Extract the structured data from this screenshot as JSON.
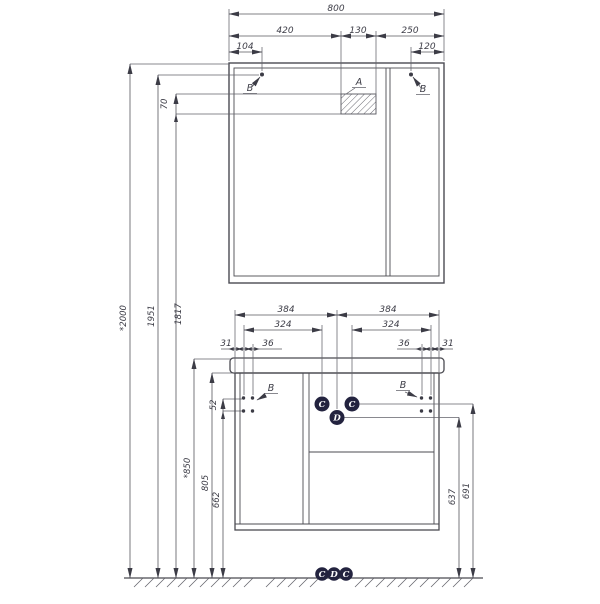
{
  "drawing": {
    "type": "technical-drawing",
    "subject": "Bathroom mirror cabinet and vanity unit, front elevation with installation dimensions",
    "units": "mm",
    "colors": {
      "line": "#4b4b52",
      "dim_line": "#56565e",
      "text": "#3c3c46",
      "badge_fill": "#23233f",
      "badge_text": "#ffffff",
      "background": "#ffffff"
    },
    "mirror_cabinet": {
      "width_total": "800",
      "width_left": "420",
      "width_niche": "130",
      "width_right": "250",
      "hole_offset_left": "104",
      "hole_offset_right": "120",
      "niche_height": "70"
    },
    "heights": {
      "overall": "*2000",
      "mirror_holes": "1951",
      "niche_bottom": "1817",
      "countertop": "*850",
      "body_top": "805",
      "lower_holes": "662",
      "hole_row_gap": "52",
      "c_row": "691",
      "d_row": "637"
    },
    "vanity": {
      "half_width_left": "384",
      "half_width_right": "384",
      "hole_span_left": "324",
      "hole_span_right": "324",
      "edge_offset_left": "31",
      "hole_gap_left": "36",
      "hole_gap_right": "36",
      "edge_offset_right": "31"
    },
    "callouts": {
      "a": "A",
      "b": "B",
      "c": "C",
      "d": "D"
    }
  }
}
